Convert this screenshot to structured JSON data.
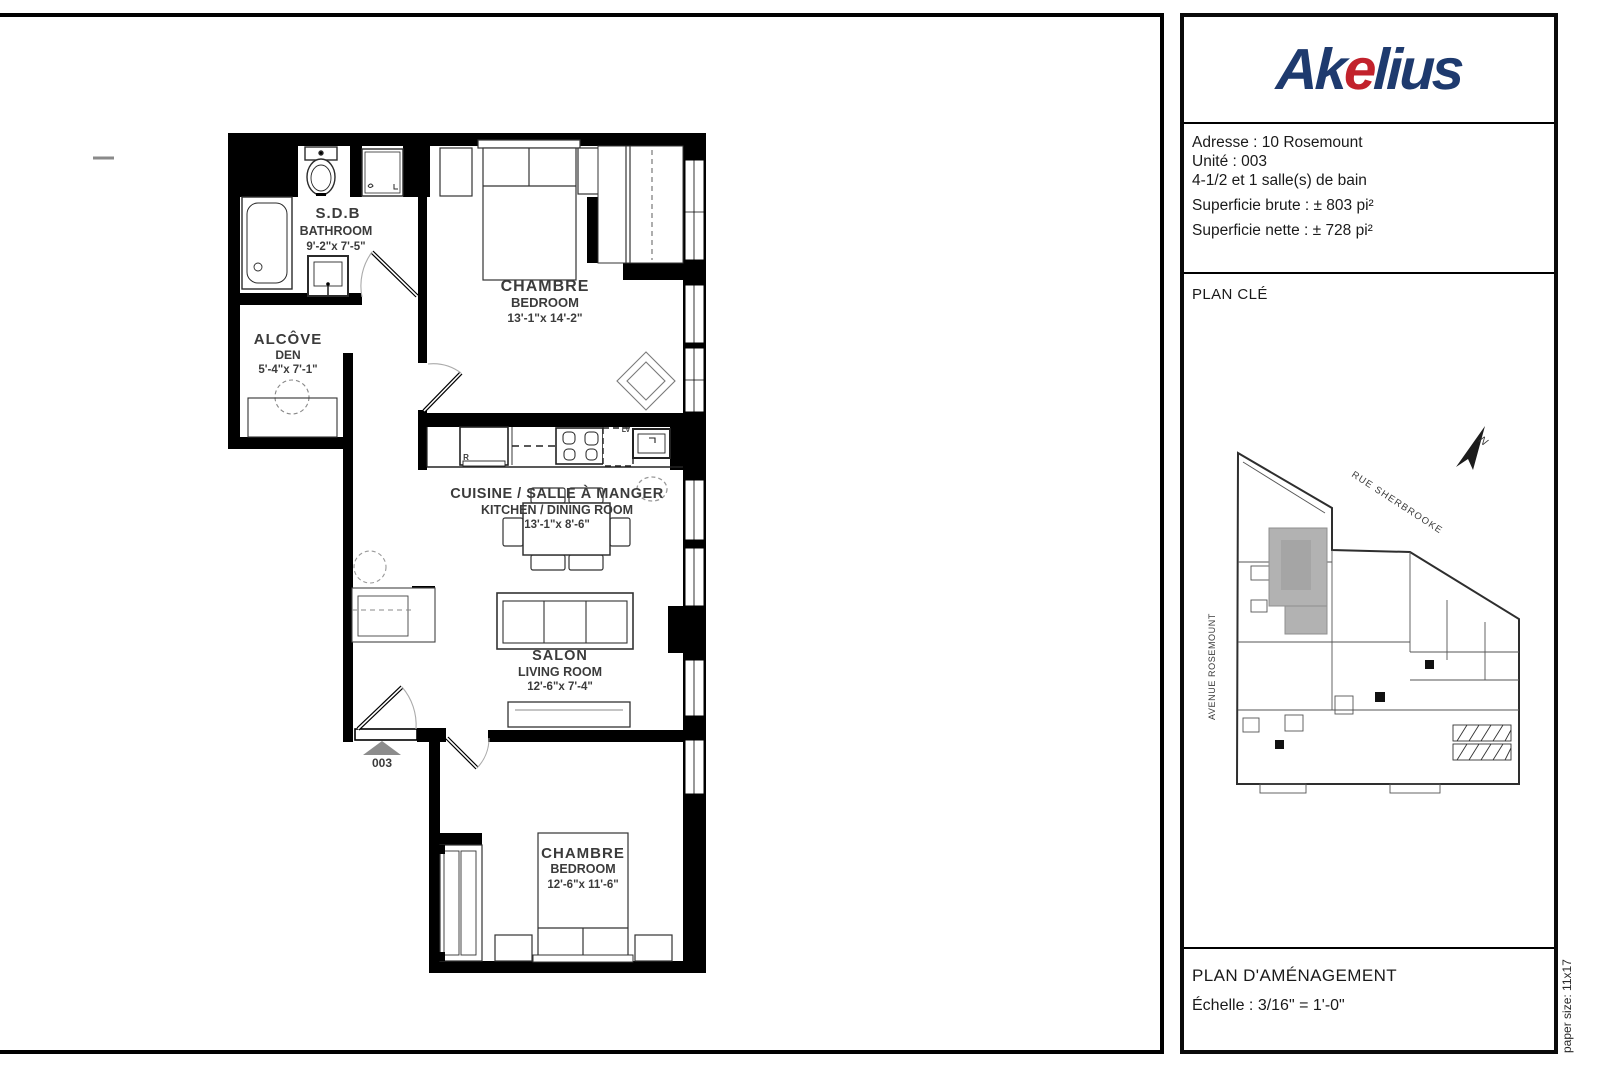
{
  "floor_plan": {
    "unit_marker": "003",
    "rooms": {
      "bathroom": {
        "name_fr": "S.D.B",
        "name_en": "BATHROOM",
        "dims": "9'-2\"x 7'-5\""
      },
      "alcove": {
        "name_fr": "ALCÔVE",
        "name_en": "DEN",
        "dims": "5'-4\"x 7'-1\""
      },
      "bedroom_top": {
        "name_fr": "CHAMBRE",
        "name_en": "BEDROOM",
        "dims": "13'-1\"x 14'-2\""
      },
      "kitchen": {
        "name_fr": "CUISINE / SALLE À MANGER",
        "name_en": "KITCHEN / DINING ROOM",
        "dims": "13'-1\"x 8'-6\""
      },
      "living": {
        "name_fr": "SALON",
        "name_en": "LIVING ROOM",
        "dims": "12'-6\"x 7'-4\""
      },
      "bedroom_bottom": {
        "name_fr": "CHAMBRE",
        "name_en": "BEDROOM",
        "dims": "12'-6\"x 11'-6\""
      }
    },
    "appliance_labels": {
      "fridge": "R",
      "dishwasher": "LV"
    }
  },
  "panel": {
    "logo": {
      "text_start": "Ak",
      "text_accent": "e",
      "text_end": "lius",
      "navy": "#1e3a6e",
      "red": "#c2222c"
    },
    "info": {
      "address": "Adresse : 10 Rosemount",
      "unit": "Unité : 003",
      "layout": "4-1/2 et 1 salle(s) de bain",
      "gross_area": "Superficie brute : ± 803 pi²",
      "net_area": "Superficie nette : ± 728 pi²"
    },
    "key_plan": {
      "title": "PLAN CLÉ",
      "street_top": "RUE SHERBROOKE",
      "street_left": "AVENUE ROSEMOUNT",
      "north": "N"
    },
    "footer": {
      "title": "PLAN D'AMÉNAGEMENT",
      "scale": "Échelle : 3/16\" = 1'-0\""
    },
    "paper_size": "paper size: 11x17"
  }
}
